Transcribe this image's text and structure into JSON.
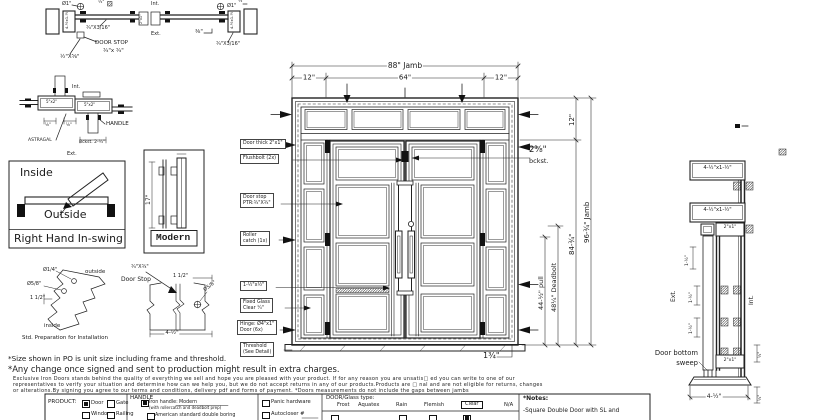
{
  "top_section": {
    "dia_left": "Ø1\"",
    "half_top": "½\"",
    "jamb_left": "4-½x1-½",
    "bar_left": "¾\"X3/16\"",
    "door_stop": "DOOR STOP",
    "door_stop_size": "¾\"x ¾\"",
    "astragal_size": "½\"X⅝\"",
    "int": "Int.",
    "ext": "Ext.",
    "tube": "2\"x1\"",
    "three_eighths": "⅜\"",
    "dia_right": "Ø1\"",
    "half_right": "½\"",
    "bar_right": "¾\"X3/16\"",
    "jamb_right": "4-½x1-½"
  },
  "meeting_plan": {
    "int": "Int.",
    "tube1": "5\"x2\"",
    "tube2": "5\"x2\"",
    "handle": "HANDLE",
    "astragal": "ASTRAGAL",
    "backset": "Bckst. 2-¾\"",
    "ext": "Ext.",
    "dim1": "⅛\"",
    "dim2": "⅛\""
  },
  "swing": {
    "inside": "Inside",
    "outside": "Outside",
    "title": "Right Hand In-swing"
  },
  "handle_detail": {
    "height": "17\"",
    "name": "Modern"
  },
  "std_prep": {
    "dia_small": "Ø1/4\"",
    "outside": "outside",
    "dia_large": "Ø5/8\"",
    "offset": "1 1/2\"",
    "inside": "inside",
    "caption": "Std. Preparation for Installation"
  },
  "stop_detail": {
    "size": "¾\"X¾\"",
    "title": "Door Stop",
    "offset": "1 1/2\"",
    "dia": "Ø5/8\"",
    "width": "4-½\""
  },
  "elevation": {
    "dim_overall": "88\" Jamb",
    "dim_left": "12\"",
    "dim_center": "64\"",
    "dim_right": "12\"",
    "dim_transom": "12\"",
    "backset_frac": "2⅜\"",
    "backset_word": "bckst.",
    "dim_door": "84-¾\"",
    "dim_jamb": "96-¾\" Jamb",
    "dim_pull": "44-½\" pull",
    "dim_deadbolt": "48¼\" Deadbolt",
    "dim_threshold": "1¾\"",
    "labels": {
      "door_thick": "Door thick 2\"x1\"",
      "flushbolt": "Flushbolt (2x)",
      "door_stop1": "Door stop",
      "door_stop2": "PTR:¾\"X¾\"",
      "roller1": "Roller",
      "roller2": "catch  (1x)",
      "drip": "1-½\"x½\"",
      "glass1": "Fixed Glass",
      "glass2": "Clear ¼\"",
      "hinge1": "Hinge: Ø4\"x1\"",
      "hinge2": "Door (6x)",
      "threshold1": "Threshold",
      "threshold2": "(See Detail)"
    }
  },
  "right_section": {
    "jamb_top": "4-½\"x1-½\"",
    "jamb_mid": "4-½\"x1-½\"",
    "tube_top": "2\"x1\"",
    "tube_bottom": "2\"x1\"",
    "dim_a": "1-½\"",
    "dim_b": "1-½\"",
    "dim_c": "1-½\"",
    "ext": "Ext.",
    "int": "Int.",
    "sweep1": "Door bottom",
    "sweep2": "sweep",
    "dim_bottom": "4-½\"",
    "dim_r1": "½\"",
    "dim_r2": "½\""
  },
  "notes": {
    "size_note": "*Size shown in PO is unit size including frame and threshold.",
    "change_note": "*Any change once signed and sent to production might result in extra charges.",
    "fine1": "Exclusive Iron Doors stands behind the quality of everything we sell and hope you are pleased with your product. If for any reason you are unsatis□ ed you can write to one of our",
    "fine2": "representatives to verify your situation and determine how can we help you, but we do not accept returns in any of our products.Products are □ nal and are not eligible for returns, changes",
    "fine3": "or alterations.By signing you agree to our terms and conditions, delivery pdf and forms of payment. *Doors measurements do not include the gaps between jambs"
  },
  "form": {
    "product_label": "PRODUCT:",
    "opt_door": "Door",
    "opt_gate": "Gate",
    "opt_window": "Window",
    "opt_railing": "Railing",
    "product_selected": "Door",
    "handle_label": "HANDLE",
    "iron_handle_label": "Iron handle:",
    "iron_handle_value": "Modern",
    "iron_handle_sub": "(with rollercatch and deadbolt prep)",
    "american": "American standard double boring",
    "panic": "Panic hardware",
    "autocloser": "Autocloser #",
    "glass_label": "DOOR/Glass type:",
    "glass_options": [
      "Frost",
      "Aquatex",
      "Rain",
      "Flemish",
      "Clear",
      "N/A"
    ],
    "glass_selected": "Clear",
    "notes_label": "*Notes:",
    "notes_line": "-Square Double Door with SL and"
  }
}
